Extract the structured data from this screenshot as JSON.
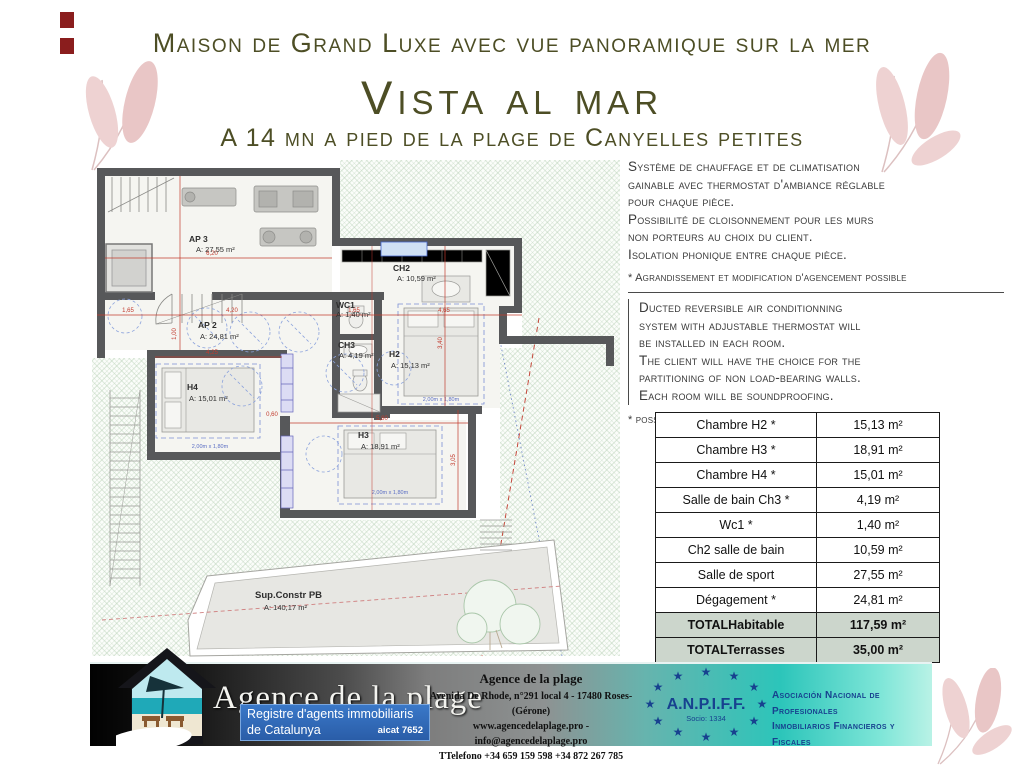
{
  "header": {
    "line1": "Maison de Grand Luxe avec vue panoramique sur la mer",
    "title": "Vista al mar",
    "line3": "A 14 mn a pied de la plage de Canyelles petites"
  },
  "french": {
    "lines": [
      "Système de chauffage et de climatisation",
      "gainable avec thermostat d'ambiance réglable",
      "pour chaque pièce.",
      "Possibilité de cloisonnement pour les murs",
      "non porteurs au choix du client.",
      "Isolation phonique entre chaque pièce."
    ],
    "note": "* Agrandissement et modification d'agencement possible"
  },
  "english": {
    "lines": [
      "Ducted reversible air conditionning",
      "system with adjustable thermostat will",
      "be installed in each room.",
      "The client will have the choice for the",
      "partitioning of non load-bearing walls.",
      "Each room will be soundproofing."
    ],
    "note": "* possible extension and modification of the layout"
  },
  "table": {
    "rows": [
      {
        "label": "Chambre H2 *",
        "value": "15,13 m²",
        "total": false
      },
      {
        "label": "Chambre H3 *",
        "value": "18,91 m²",
        "total": false
      },
      {
        "label": "Chambre H4 *",
        "value": "15,01 m²",
        "total": false
      },
      {
        "label": "Salle de bain Ch3 *",
        "value": "4,19 m²",
        "total": false
      },
      {
        "label": "Wc1 *",
        "value": "1,40 m²",
        "total": false
      },
      {
        "label": "Ch2 salle de bain",
        "value": "10,59 m²",
        "total": false
      },
      {
        "label": "Salle de sport",
        "value": "27,55 m²",
        "total": false
      },
      {
        "label": "Dégagement *",
        "value": "24,81 m²",
        "total": false
      },
      {
        "label": "TOTALHabitable",
        "value": "117,59 m²",
        "total": true
      },
      {
        "label": "TOTALTerrasses",
        "value": "35,00 m²",
        "total": true
      }
    ]
  },
  "floorplan": {
    "rooms": {
      "ap3": {
        "name": "AP 3",
        "area": "A: 27,55 m²"
      },
      "ap2": {
        "name": "AP 2",
        "area": "A: 24,81 m²"
      },
      "ch2": {
        "name": "CH2",
        "area": "A: 10,59 m²"
      },
      "wc1": {
        "name": "WC1",
        "area": "A: 1,40 m²"
      },
      "ch3": {
        "name": "CH3",
        "area": "A: 4,19 m²"
      },
      "h2": {
        "name": "H2",
        "area": "A: 15,13 m²"
      },
      "h4": {
        "name": "H4",
        "area": "A: 15,01 m²"
      },
      "h3": {
        "name": "H3",
        "area": "A: 18,91 m²"
      },
      "pb": {
        "name": "Sup.Constr PB",
        "area": "A: 140,17 m²"
      }
    },
    "dims": {
      "a": "6,20",
      "b1": "1,65",
      "b2": "4,20",
      "b3": "1,65",
      "b4": "4,65",
      "c": "1,00",
      "d": "3,40",
      "e": "3,05",
      "f": "4,25",
      "g": "5,80",
      "h": "0,60"
    },
    "bed_dim": "2,00m x 1,80m"
  },
  "footer": {
    "brand": "Agence de la plage",
    "badge": {
      "line1": "Registre d'agents immobiliaris",
      "line2": "de Catalunya",
      "code": "aicat 7652"
    },
    "center": {
      "title": "Agence de la plage",
      "address": "Avenida De Rhode, n°291 local 4 - 17480 Roses- (Gérone)",
      "web": "www.agencedelaplage.pro - info@agencedelaplage.pro",
      "phone": "TTelefono +34 659 159 598  +34 872 267 785"
    },
    "anpiff": {
      "name": "A.N.P.I.F.F.",
      "member": "Socio: 1334",
      "desc1": "Asociación Nacional de Profesionales",
      "desc2": "Inmobiliarios Financieros y Fiscales"
    }
  },
  "colors": {
    "title_olive": "#4d4e25",
    "total_row_bg": "#ccd6cc",
    "badge_blue": "#2a5da8",
    "anpiff_blue": "#17418f",
    "teal_accent": "#2cc5ba",
    "leaf_pink": "#eed2d2"
  }
}
